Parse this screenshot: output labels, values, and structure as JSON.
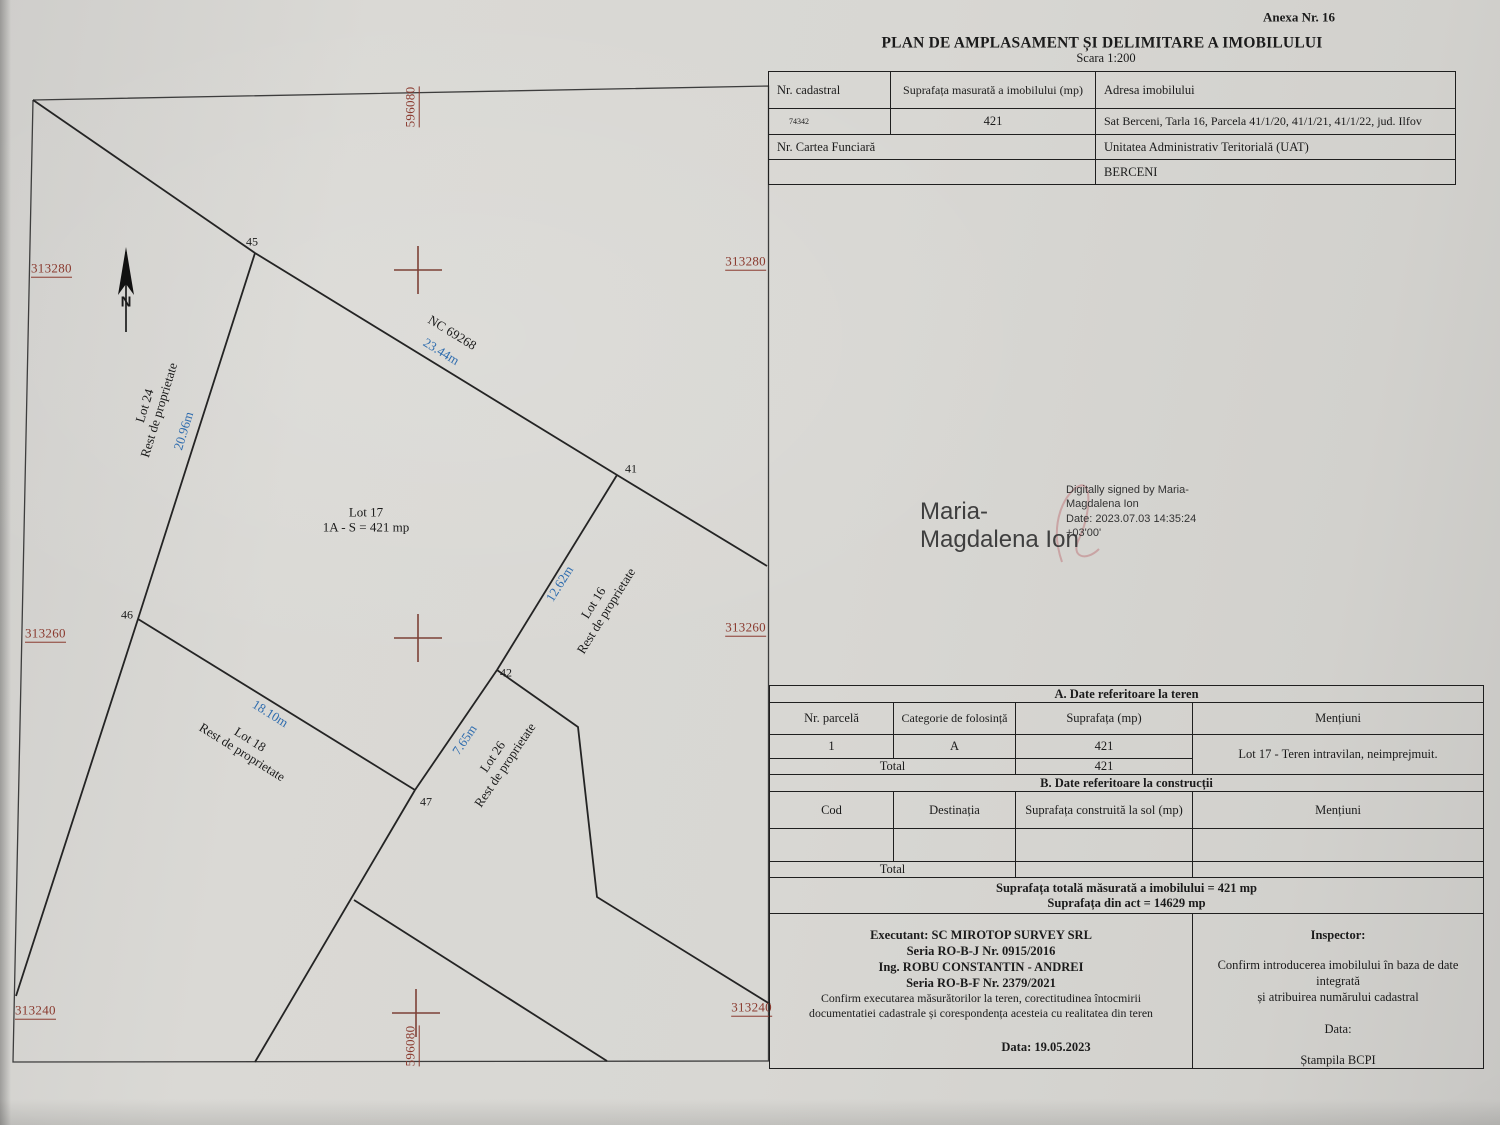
{
  "colors": {
    "label_red": "#8a3a2f",
    "cross_red": "#7c4136",
    "dim_blue": "#2e6cae",
    "ink": "#1b1b1b",
    "paper": "#d8d7d3",
    "sig_gray": "#3f3f3f"
  },
  "page": {
    "annex": "Anexa Nr. 16",
    "title": "PLAN DE AMPLASAMENT ȘI DELIMITARE A IMOBILULUI",
    "scale": "Scara 1:200"
  },
  "header_table": {
    "nr_cadastral_label": "Nr. cadastral",
    "suprafata_label": "Suprafața masurată a imobilului (mp)",
    "adresa_label": "Adresa imobilului",
    "nr_cadastral_value": "74342",
    "suprafata_value": "421",
    "adresa_value": "Sat Berceni, Tarla 16, Parcela 41/1/20, 41/1/21, 41/1/22, jud. Ilfov",
    "cartea_funciara_label": "Nr. Cartea Funciară",
    "uat_label": "Unitatea Administrativ Teritorială (UAT)",
    "uat_value": "BERCENI"
  },
  "signature": {
    "name_line1": "Maria-",
    "name_line2": "Magdalena Ion",
    "detail_line1": "Digitally signed by Maria-",
    "detail_line2": "Magdalena Ion",
    "detail_line3": "Date: 2023.07.03 14:35:24",
    "detail_line4": "+03'00'"
  },
  "plan": {
    "north_letter": "N",
    "easting_top": "596080",
    "easting_bottom": "596080",
    "northing_left": [
      "313280",
      "313260",
      "313240"
    ],
    "northing_right": [
      "313280",
      "313260",
      "313240"
    ],
    "points": {
      "p45": "45",
      "p41": "41",
      "p42": "42",
      "p46": "46",
      "p47": "47"
    },
    "nc_label": "NC 69268",
    "dim_top": "23.44m",
    "dim_left": "20.96m",
    "dim_right": "12.62m",
    "dim_bottom": "18.10m",
    "dim_inner": "7.65m",
    "lot17_line1": "Lot 17",
    "lot17_line2": "1A - S = 421 mp",
    "lot24_line1": "Lot 24",
    "lot24_line2": "Rest de proprietate",
    "lot16_line1": "Lot 16",
    "lot16_line2": "Rest de proprietate",
    "lot18_line1": "Lot 18",
    "lot18_line2": "Rest de proprietate",
    "lot26_line1": "Lot 26",
    "lot26_line2": "Rest de proprietate"
  },
  "table_a": {
    "title": "A. Date referitoare la teren",
    "headers": [
      "Nr. parcelă",
      "Categorie de folosință",
      "Suprafața (mp)",
      "Mențiuni"
    ],
    "row": [
      "1",
      "A",
      "421"
    ],
    "mentions": "Lot 17 - Teren intravilan, neimprejmuit.",
    "total_label": "Total",
    "total_value": "421"
  },
  "table_b": {
    "title": "B. Date referitoare la construcții",
    "headers": [
      "Cod",
      "Destinația",
      "Suprafața construită la sol (mp)",
      "Mențiuni"
    ],
    "total_label": "Total"
  },
  "totals": {
    "line1": "Suprafața totală măsurată a imobilului = 421 mp",
    "line2": "Suprafața din act = 14629 mp"
  },
  "executant": {
    "line1": "Executant:  SC MIROTOP SURVEY SRL",
    "line2": "Seria RO-B-J Nr. 0915/2016",
    "line3": "Ing. ROBU CONSTANTIN - ANDREI",
    "line4": "Seria RO-B-F Nr. 2379/2021",
    "line5": "Confirm executarea măsurătorilor la teren, corectitudinea întocmirii",
    "line6": "documentatiei cadastrale și corespondența acesteia cu realitatea din teren",
    "date": "Data: 19.05.2023"
  },
  "inspector": {
    "title": "Inspector:",
    "line1": "Confirm introducerea imobilului în baza de date",
    "line2": "integrată",
    "line3": "și atribuirea numărului cadastral",
    "date_label": "Data:",
    "stamp": "Ștampila BCPI"
  }
}
